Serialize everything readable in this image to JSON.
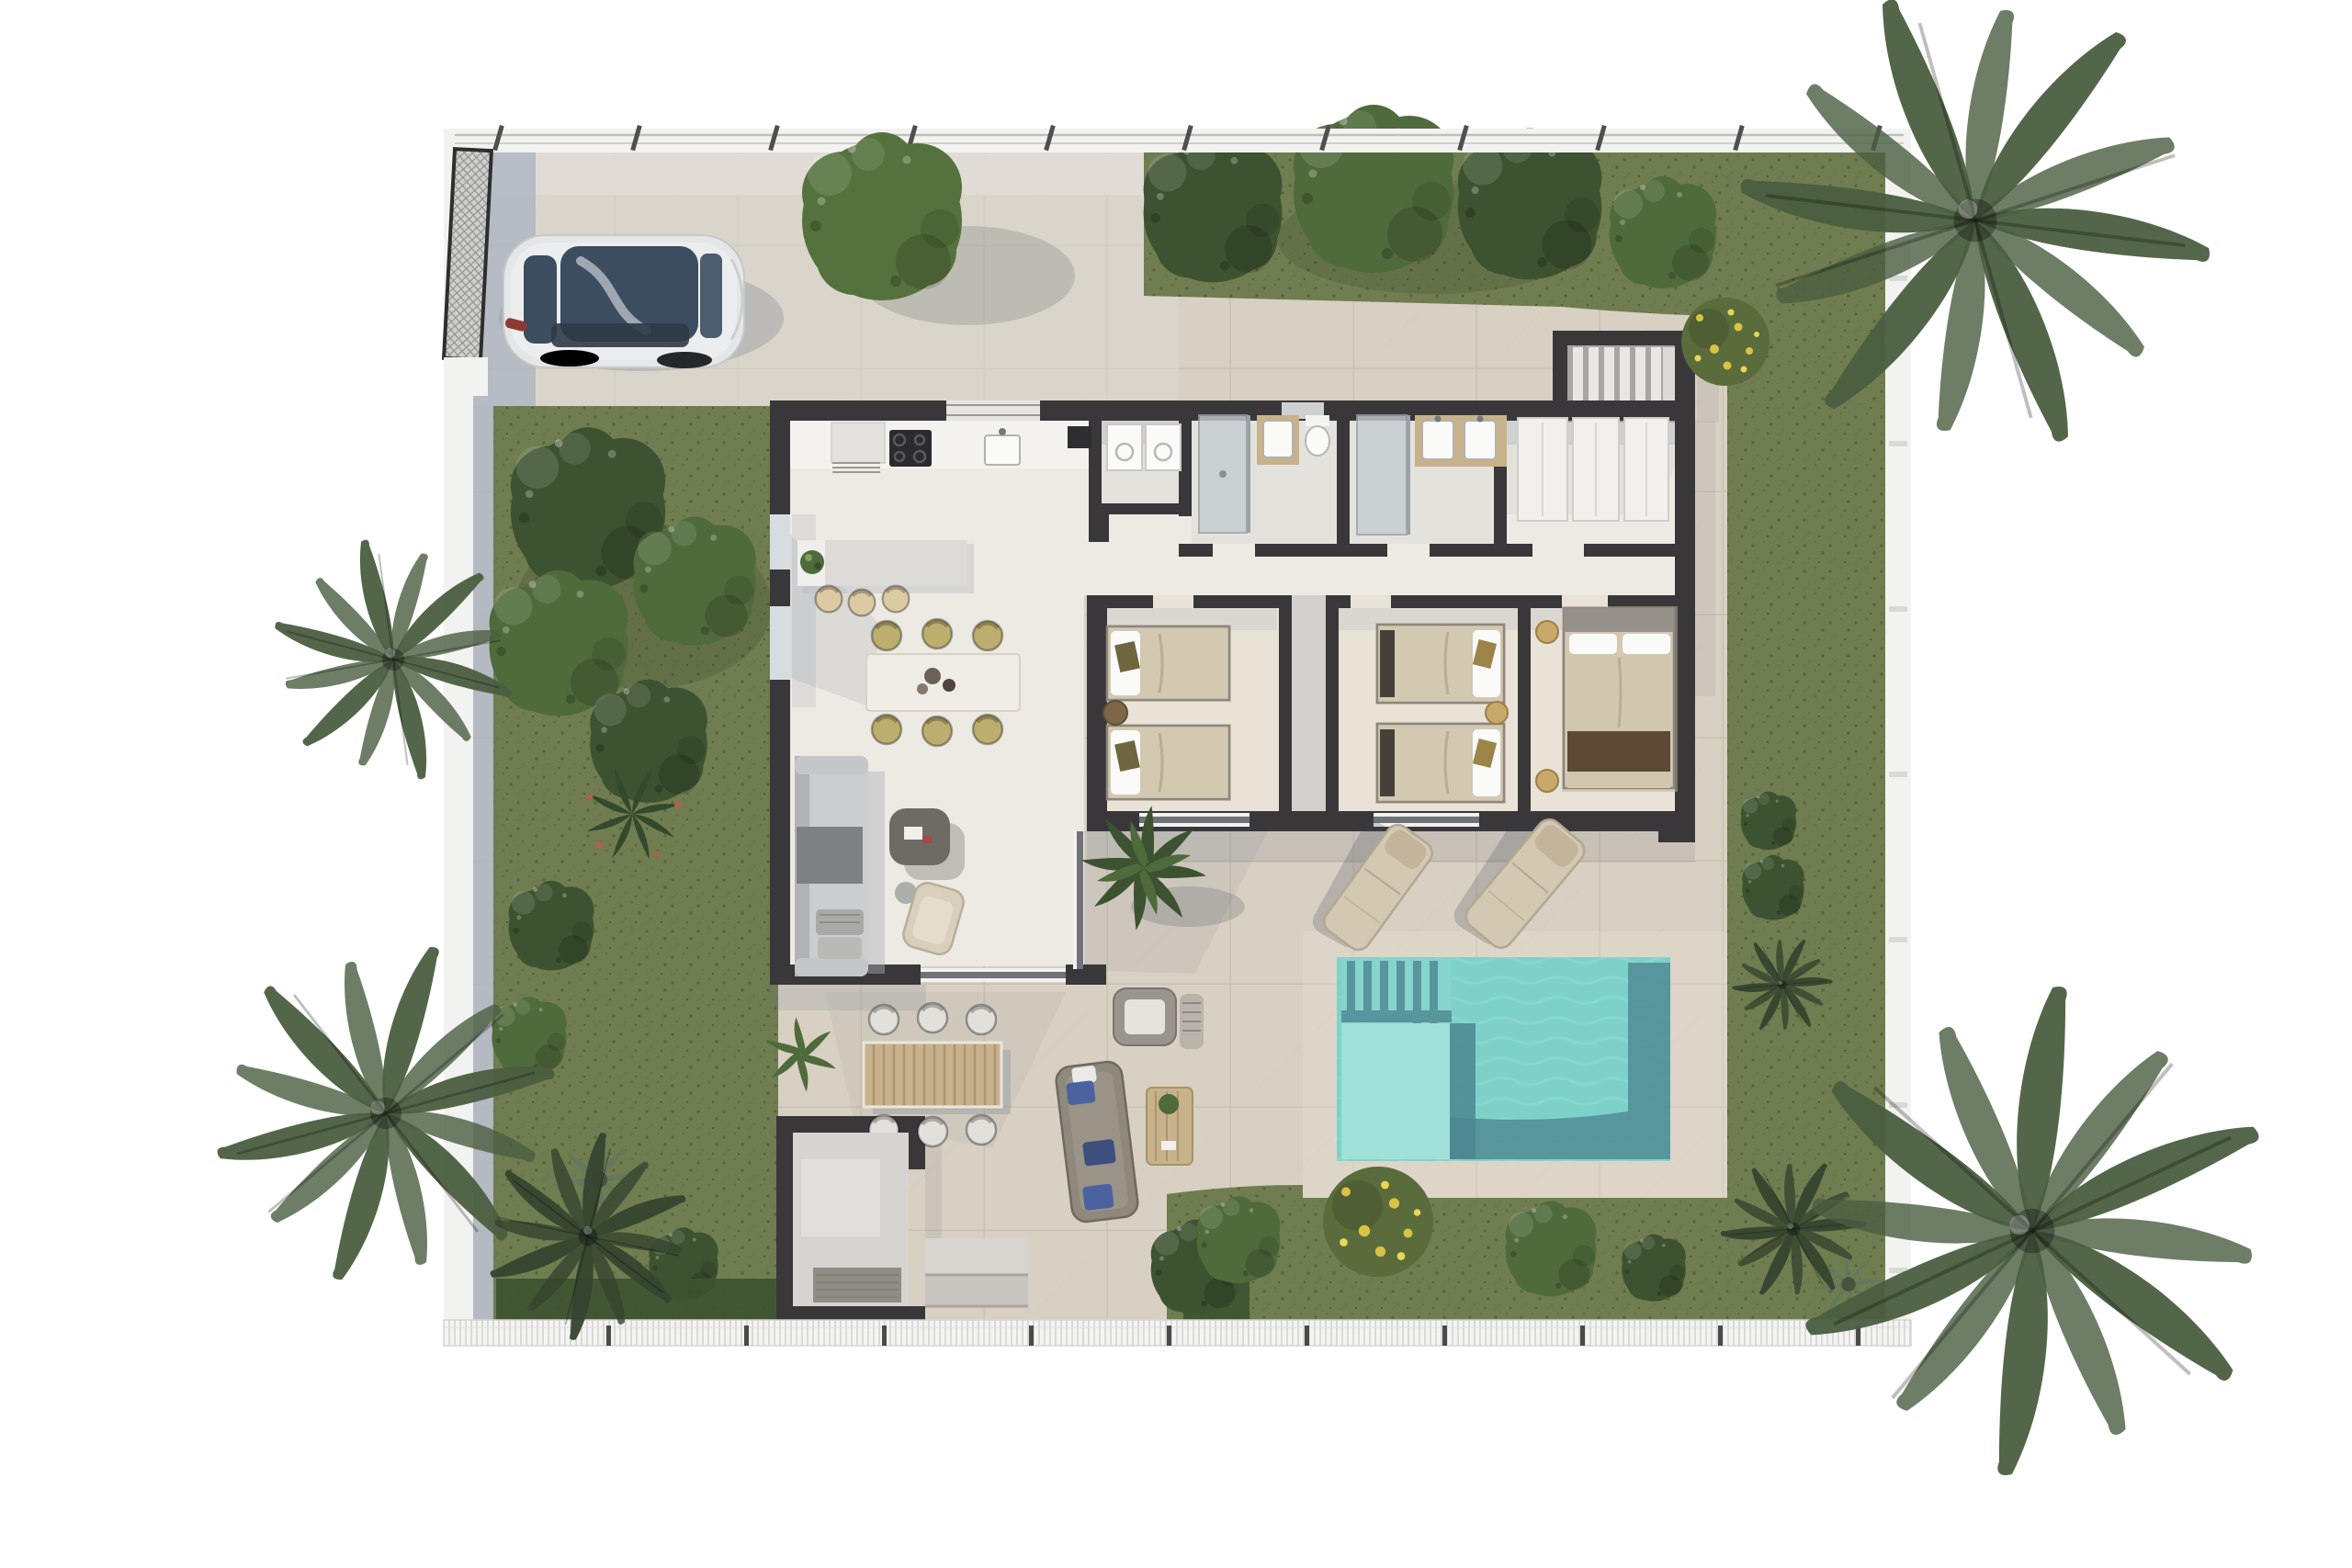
{
  "scene": {
    "type": "architectural-floor-plan-3d-render",
    "view": "top-down",
    "description": "Photorealistic top-down render of a single-storey villa plot with walled garden, driveway with parked silver car, entrance gate, lawn areas, palm trees, swimming pool with sun loungers, covered porch with outdoor dining and lounge furniture",
    "rooms": [
      {
        "label": "kitchen"
      },
      {
        "label": "dining-area"
      },
      {
        "label": "living-room"
      },
      {
        "label": "laundry"
      },
      {
        "label": "bathroom-1"
      },
      {
        "label": "bathroom-2"
      },
      {
        "label": "dressing-corridor"
      },
      {
        "label": "bedroom-1",
        "beds": 2
      },
      {
        "label": "bedroom-2",
        "beds": 2
      },
      {
        "label": "master-bedroom",
        "beds": 1
      },
      {
        "label": "entry-vestibule"
      },
      {
        "label": "staircase"
      },
      {
        "label": "covered-porch"
      },
      {
        "label": "pool-terrace"
      }
    ],
    "counts": {
      "bedrooms": 3,
      "bathrooms": 2,
      "twin_beds": 4,
      "double_beds": 1,
      "sun_loungers": 2,
      "cars": 1,
      "pools": 1,
      "palm_trees": 5,
      "garden_trees": 9
    },
    "furniture": [
      "kitchen-counter",
      "kitchen-island",
      "bar-stools",
      "dining-table",
      "dining-chairs",
      "sofa",
      "coffee-table",
      "armchair",
      "potted-plant",
      "outdoor-dining-table",
      "outdoor-chairs",
      "outdoor-sofa",
      "outdoor-armchair",
      "outdoor-coffee-table",
      "sun-loungers",
      "twin-beds",
      "double-bed",
      "wardrobes",
      "washer-dryer",
      "double-vanity",
      "shower",
      "toilet"
    ]
  },
  "palette": {
    "bg": "#ffffff",
    "paving": "#d8d0c2",
    "pavingLine": "#c4bcab",
    "pavingLight": "#e0ddd6",
    "deck": "#ddd6c8",
    "floor": "#edeae3",
    "floorBed": "#e8e2d7",
    "floorGray": "#d2d0cc",
    "wall": "#3a373a",
    "boundary": "#f2f2f0",
    "boundaryShadow": "#a9b2c1",
    "fence": "#c6c6c4",
    "grass": "#6f7d50",
    "grassDark": "#55663e",
    "treeDark": "#3d5230",
    "treeMid": "#4f6a3b",
    "treeLight": "#6e8c50",
    "driveTree": "#55713d",
    "palmGreen": "#4b5e41",
    "palmDark": "#36452f",
    "bushYellowBase": "#5a6b3c",
    "flowerYellow": "#d9c344",
    "pool": "#7ed1c9",
    "poolLight": "#9fe0d8",
    "poolShadow": "#4c8791",
    "carBody": "#e4e6e7",
    "carGlass": "#3c4d60",
    "carShadow": "#9da2a5",
    "wood": "#c7b28b",
    "woodSlat": "#ac9671",
    "fabric": "#d3c8b2",
    "fabricDark": "#b3a892",
    "olive": "#bcae6e",
    "oliveDark": "#6f653f",
    "gold": "#c9a96a",
    "bluePillow": "#4a63a0",
    "sofa": "#cbcdcf",
    "sofaBack": "#b1b4b6",
    "sofaDark": "#7e8083",
    "taupe": "#8f897d",
    "counter": "#f3f2ef",
    "appliance": "#2b2b2d",
    "glassLine": "#6f7276",
    "shadow": "#6d7486",
    "white": "#fafaf9"
  }
}
